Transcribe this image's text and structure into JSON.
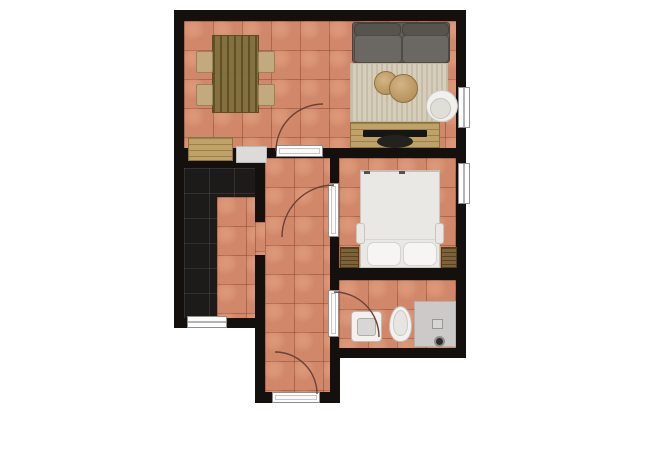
{
  "page": {
    "background": "#ffffff",
    "content": "apartment-floor-plan"
  },
  "palette": {
    "wall": "#13100e",
    "tile": "#d1886a",
    "tile_grout": "#92492e",
    "darktile": "#1d1b1a",
    "door_leaf": "#fafafa",
    "door_frame": "#8d8d8d",
    "swing_arc": "#6b4238",
    "rug": "#d6cdba",
    "sofa": "#605c58",
    "wood_light": "#bfa268",
    "wood_table": "#84713f",
    "wood_dark": "#7c6339",
    "fixture_white": "#f2f1ef",
    "tray": "#cbcac8"
  },
  "floorplan": {
    "rooms": [
      {
        "name": "living-dining-room",
        "floor": "terracotta-tile"
      },
      {
        "name": "kitchen",
        "floor": "dark-tile"
      },
      {
        "name": "hallway",
        "floor": "terracotta-tile"
      },
      {
        "name": "bedroom",
        "floor": "terracotta-tile"
      },
      {
        "name": "bathroom",
        "floor": "terracotta-tile"
      },
      {
        "name": "entry",
        "floor": "terracotta-tile"
      }
    ],
    "windows": [
      "living-room-window-right",
      "bedroom-window-right",
      "kitchen-window-bottom"
    ],
    "doors": [
      "living-room-door",
      "bedroom-door",
      "bathroom-door",
      "entry-door"
    ],
    "furniture": {
      "living-dining-room": [
        "dining-table",
        "dining-chair-x4",
        "sideboard",
        "appliance",
        "sofa",
        "rug",
        "pouf-small",
        "pouf-large",
        "round-chair",
        "tv-stand",
        "tv"
      ],
      "bedroom": [
        "double-bed",
        "pillow-x2",
        "nightstand-left",
        "nightstand-right"
      ],
      "bathroom": [
        "sink",
        "toilet",
        "shower-tray"
      ]
    }
  }
}
